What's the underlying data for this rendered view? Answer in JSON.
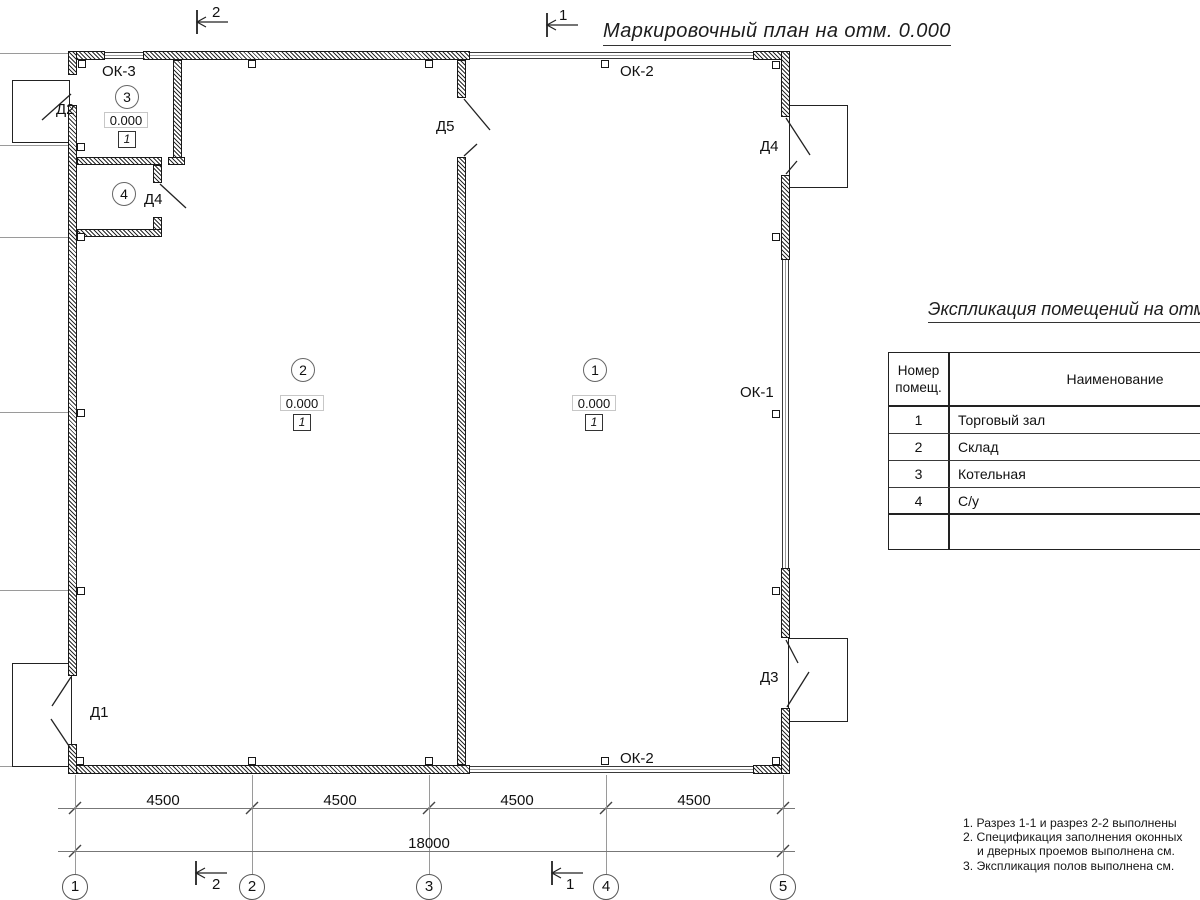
{
  "title": "Маркировочный план на отм. 0.000",
  "colors": {
    "ink": "#1a1a1a",
    "thin_line": "#9a9a9a",
    "wall_hatch": "#2a2a2a"
  },
  "rooms": {
    "r1": {
      "num": "1",
      "elev": "0.000",
      "floor": "1"
    },
    "r2": {
      "num": "2",
      "elev": "0.000",
      "floor": "1"
    },
    "r3": {
      "num": "3",
      "elev": "0.000",
      "floor": "1"
    },
    "r4": {
      "num": "4"
    }
  },
  "doors": {
    "d1": "Д1",
    "d2": "Д2",
    "d3": "Д3",
    "d4_inner": "Д4",
    "d4_right": "Д4",
    "d5": "Д5"
  },
  "windows": {
    "ok1": "ОК-1",
    "ok2_top": "ОК-2",
    "ok2_bottom": "ОК-2",
    "ok3": "ОК-3"
  },
  "dimensions": {
    "segments": [
      "4500",
      "4500",
      "4500",
      "4500"
    ],
    "total": "18000"
  },
  "axes": {
    "bubbles": [
      "1",
      "2",
      "3",
      "4",
      "5"
    ]
  },
  "sections": {
    "top_2": "2",
    "top_1": "1",
    "bottom_2": "2",
    "bottom_1": "1"
  },
  "legend_table": {
    "title": "Экспликация помещений на отм. 0.000",
    "col1_header_line1": "Номер",
    "col1_header_line2": "помещ.",
    "col2_header": "Наименование",
    "rows": [
      {
        "num": "1",
        "name": "Торговый зал"
      },
      {
        "num": "2",
        "name": "Склад"
      },
      {
        "num": "3",
        "name": "Котельная"
      },
      {
        "num": "4",
        "name": "С/у"
      }
    ]
  },
  "notes": [
    "1. Разрез 1-1 и разрез 2-2 выполнены",
    "2. Спецификация заполнения оконных",
    "и дверных проемов выполнена см.",
    "3. Экспликация полов выполнена см."
  ]
}
